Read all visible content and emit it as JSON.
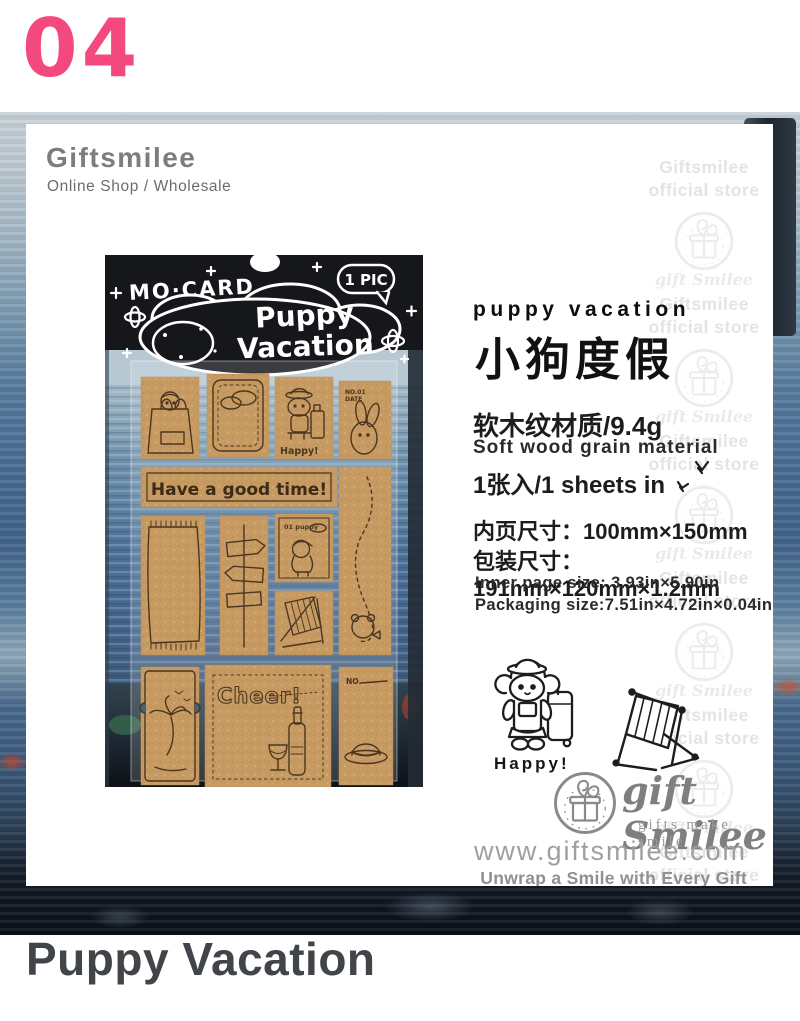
{
  "page": {
    "index": "04",
    "title": "Puppy Vacation"
  },
  "header": {
    "brand": "Giftsmilee",
    "subtitle": "Online Shop / Wholesale"
  },
  "watermark": {
    "line1": "Giftsmilee",
    "line2": "official store",
    "brand_script": "gift Smilee",
    "repeats": 6
  },
  "photo": {
    "brand": "MO·CARD",
    "badge": "1 PIC",
    "title_line1": "Puppy",
    "title_line2": "Vacation",
    "banner": "Have a good time!",
    "happy": "Happy!",
    "stamp_no": "NO.01",
    "stamp_date": "DATE",
    "dog_tag": "01 puppy",
    "cheer": "Cheer!",
    "tag_no": "NO."
  },
  "details": {
    "title_en": "puppy vacation",
    "title_zh": "小狗度假",
    "material_zh": "软木纹材质/9.4g",
    "material_en": "Soft wood grain material",
    "sheets": "1张入/1 sheets in",
    "inner_size_zh": "内页尺寸：100mm×150mm",
    "package_size_zh": "包装尺寸：191mm×120mm×1.2mm",
    "inner_size_en": "Inner page size: 3.93in×5.90in",
    "package_size_en": "Packaging size:7.51in×4.72in×0.04in",
    "happy_label": "Happy!"
  },
  "footer": {
    "logo_script": "gift Smilee",
    "logo_tagline": "gifts make smile",
    "website": "www.giftsmilee.com",
    "slogan": "Unwrap a Smile with Every Gift"
  },
  "colors": {
    "accent_pink": "#f4497f",
    "cork": "#c79a62",
    "title_gray": "#41454a"
  }
}
